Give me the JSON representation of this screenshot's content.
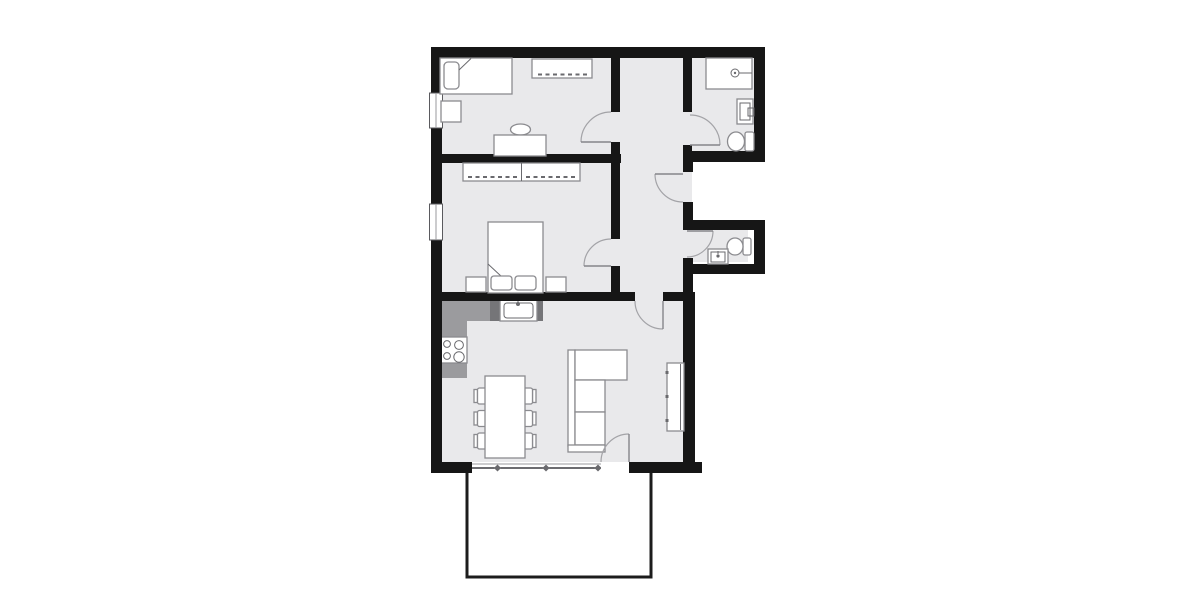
{
  "canvas": {
    "width": 1200,
    "height": 600
  },
  "colors": {
    "wall": "#161616",
    "floor": "#e9e9eb",
    "counter_light": "#9b9b9e",
    "counter_dark": "#757578",
    "furniture_outline": "#8b8b8f",
    "furniture_fill": "#ffffff",
    "door_arc": "#a3a3a7",
    "window_line": "#5a5a5e",
    "terrace_border": "#1c1c1c",
    "background": "#ffffff"
  },
  "floor_plan": {
    "type": "apartment-floor-plan",
    "text_labels": [],
    "rooms": [
      {
        "name": "bedroom-1",
        "position": "top-left",
        "furniture": [
          "single-bed",
          "pillow",
          "nightstand",
          "wardrobe",
          "desk",
          "desk-chair"
        ],
        "windows": 1,
        "doors": 1
      },
      {
        "name": "bedroom-2",
        "position": "middle-left",
        "furniture": [
          "double-bed",
          "pillow",
          "pillow",
          "nightstand",
          "nightstand",
          "wardrobe"
        ],
        "windows": 1,
        "doors": 1
      },
      {
        "name": "bathroom",
        "position": "top-right",
        "furniture": [
          "shower",
          "washbasin",
          "toilet"
        ],
        "windows": 0,
        "doors": 1
      },
      {
        "name": "hallway",
        "position": "center",
        "furniture": [],
        "windows": 0,
        "doors": 1
      },
      {
        "name": "wc",
        "position": "right",
        "furniture": [
          "washbasin",
          "toilet"
        ],
        "windows": 0,
        "doors": 1
      },
      {
        "name": "kitchen-living-room",
        "position": "bottom",
        "furniture": [
          "kitchen-counter",
          "kitchen-sink",
          "cooktop",
          "dining-table",
          "dining-chair",
          "dining-chair",
          "dining-chair",
          "dining-chair",
          "dining-chair",
          "dining-chair",
          "corner-sofa",
          "tv-sideboard"
        ],
        "windows": 1,
        "doors": 2
      },
      {
        "name": "terrace",
        "position": "bottom-outside",
        "furniture": [],
        "windows": 0,
        "doors": 1
      }
    ]
  }
}
